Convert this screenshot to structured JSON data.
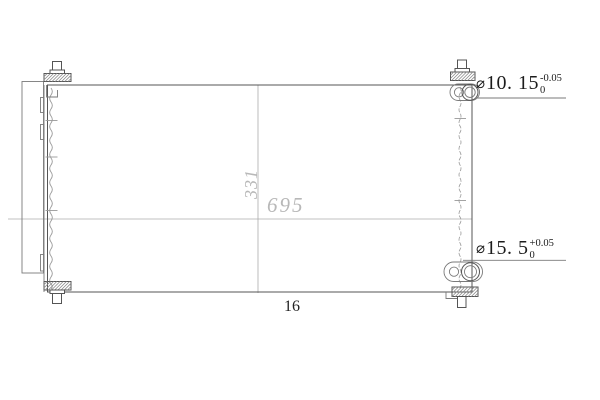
{
  "meta": {
    "type": "engineering-drawing-of-condenser",
    "background": "#ffffff"
  },
  "colors": {
    "outline": "#555555",
    "thin_line": "#7a7a7a",
    "centerline": "#ababab",
    "dim_gray_text": "#b8b8b8",
    "annotation_text": "#1c1c1c"
  },
  "dimensions": {
    "width": {
      "label": "695"
    },
    "height": {
      "label": "331"
    },
    "depth": {
      "label": "16"
    }
  },
  "ports": {
    "top": {
      "symbol": "⌀",
      "value": "10. 15",
      "upper_tol": "-0.05",
      "lower_tol": "0"
    },
    "bottom": {
      "symbol": "⌀",
      "value": "15. 5",
      "upper_tol": "+0.05",
      "lower_tol": "0"
    }
  }
}
